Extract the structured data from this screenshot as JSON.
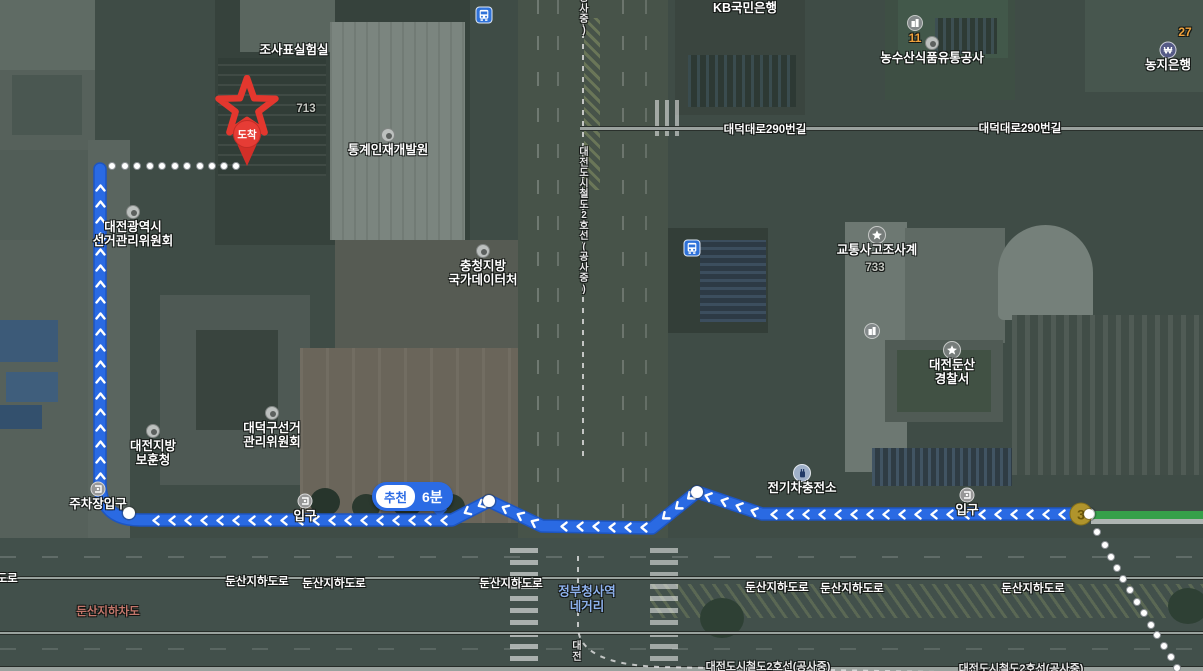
{
  "map_type": "satellite-walk-route",
  "badge": {
    "tag": "추천",
    "duration": "6분"
  },
  "destination_pin": {
    "label": "도착"
  },
  "exit_marker": {
    "number": "3"
  },
  "pois": [
    {
      "type": "label",
      "x": 294,
      "y": 44,
      "lines": [
        "조사표실험실"
      ]
    },
    {
      "type": "num_gray",
      "x": 306,
      "y": 103,
      "lines": [
        "713"
      ]
    },
    {
      "type": "dot",
      "x": 388,
      "y": 135,
      "lines": [
        "통계인재개발원"
      ]
    },
    {
      "type": "dot",
      "x": 133,
      "y": 212,
      "lines": [
        "대전광역시",
        "선거관리위원회"
      ]
    },
    {
      "type": "dot",
      "x": 483,
      "y": 251,
      "lines": [
        "충청지방",
        "국가데이터처"
      ]
    },
    {
      "type": "dot",
      "x": 272,
      "y": 413,
      "lines": [
        "대덕구선거",
        "관리위원회"
      ]
    },
    {
      "type": "dot",
      "x": 153,
      "y": 431,
      "lines": [
        "대전지방",
        "보훈청"
      ]
    },
    {
      "type": "label",
      "x": 745,
      "y": 2,
      "lines": [
        "KB국민은행"
      ]
    },
    {
      "type": "bus",
      "x": 484,
      "y": 15,
      "lines": []
    },
    {
      "type": "bus",
      "x": 692,
      "y": 248,
      "lines": []
    },
    {
      "type": "building",
      "x": 915,
      "y": 23,
      "lines": [
        "11"
      ],
      "num": "orange"
    },
    {
      "type": "dot",
      "x": 932,
      "y": 43,
      "lines": [
        "농수산식품유통공사"
      ]
    },
    {
      "type": "num_orange",
      "x": 1185,
      "y": 26,
      "lines": [
        "27"
      ]
    },
    {
      "type": "bank",
      "x": 1168,
      "y": 50,
      "lines": [
        "농지은행"
      ]
    },
    {
      "type": "police",
      "x": 877,
      "y": 235,
      "lines": [
        "교통사고조사계"
      ]
    },
    {
      "type": "num_gray",
      "x": 875,
      "y": 262,
      "lines": [
        "733"
      ]
    },
    {
      "type": "building",
      "x": 872,
      "y": 331,
      "lines": []
    },
    {
      "type": "police",
      "x": 952,
      "y": 350,
      "lines": [
        "대전둔산",
        "경찰서"
      ]
    },
    {
      "type": "ev",
      "x": 802,
      "y": 473,
      "lines": [
        "전기차충전소"
      ]
    },
    {
      "type": "entrance",
      "x": 967,
      "y": 495,
      "lines": [
        "입구"
      ]
    },
    {
      "type": "entrance",
      "x": 305,
      "y": 501,
      "lines": [
        "입구"
      ]
    },
    {
      "type": "entrance",
      "x": 98,
      "y": 489,
      "lines": [
        "주차장입구"
      ]
    }
  ],
  "road_labels": [
    {
      "text": "대덕대로290번길",
      "x": 765,
      "y": 129,
      "color": "white"
    },
    {
      "text": "대덕대로290번길",
      "x": 1020,
      "y": 128,
      "color": "white"
    },
    {
      "text": "둔산지하도로",
      "x": -14,
      "y": 578,
      "color": "white"
    },
    {
      "text": "둔산지하도로",
      "x": 257,
      "y": 581,
      "color": "white"
    },
    {
      "text": "둔산지하도로",
      "x": 334,
      "y": 583,
      "color": "white"
    },
    {
      "text": "둔산지하도로",
      "x": 511,
      "y": 583,
      "color": "white"
    },
    {
      "text": "둔산지하도로",
      "x": 777,
      "y": 587,
      "color": "white"
    },
    {
      "text": "둔산지하도로",
      "x": 852,
      "y": 588,
      "color": "white"
    },
    {
      "text": "둔산지하도로",
      "x": 1033,
      "y": 588,
      "color": "white"
    },
    {
      "text": "둔산지하차도",
      "x": 108,
      "y": 611,
      "color": "brown"
    },
    {
      "text": "정부청사역",
      "x": 587,
      "y": 590,
      "color": "blue"
    },
    {
      "text": "네거리",
      "x": 587,
      "y": 605,
      "color": "blue"
    }
  ],
  "subway_labels": [
    {
      "text": "공사중)",
      "x": 584,
      "top": -6,
      "vertical": true
    },
    {
      "text": "대전도시철도2호선(공사중)",
      "x": 584,
      "top": 148,
      "vertical": true
    },
    {
      "text": "대전",
      "x": 577,
      "top": 642,
      "vertical": true
    },
    {
      "text": "대전도시철도2호선(공사중)",
      "x": 768,
      "top": 662,
      "vertical": false
    },
    {
      "text": "대전도시철도2호선(공사중)",
      "x": 1021,
      "top": 664,
      "vertical": false
    }
  ],
  "route": {
    "color": "#2a6ae3",
    "casing": "#1d55c2",
    "d": "M1086,514 L762,514 L697,492 L652,528 L542,526 L489,501 L452,520 L140,520 Q101,520 100,484 L100,169",
    "segments": [
      [
        [
          1086,
          514
        ],
        [
          762,
          514
        ]
      ],
      [
        [
          762,
          514
        ],
        [
          697,
          492
        ]
      ],
      [
        [
          697,
          492
        ],
        [
          652,
          528
        ]
      ],
      [
        [
          652,
          528
        ],
        [
          542,
          526
        ]
      ],
      [
        [
          542,
          526
        ],
        [
          489,
          501
        ]
      ],
      [
        [
          489,
          501
        ],
        [
          452,
          520
        ]
      ],
      [
        [
          452,
          520
        ],
        [
          140,
          520
        ]
      ],
      [
        [
          100,
          484
        ],
        [
          100,
          169
        ]
      ]
    ],
    "waypoints": [
      [
        697,
        492
      ],
      [
        489,
        501
      ],
      [
        129,
        513
      ],
      [
        1089,
        514
      ]
    ],
    "dest_dots": [
      [
        112,
        166
      ],
      [
        125,
        166
      ],
      [
        137,
        166
      ],
      [
        150,
        166
      ],
      [
        162,
        166
      ],
      [
        175,
        166
      ],
      [
        187,
        166
      ],
      [
        200,
        166
      ],
      [
        212,
        166
      ],
      [
        224,
        166
      ],
      [
        236,
        166
      ]
    ],
    "start_dots": [
      [
        1097,
        532
      ],
      [
        1105,
        545
      ],
      [
        1111,
        557
      ],
      [
        1117,
        568
      ],
      [
        1123,
        579
      ],
      [
        1130,
        590
      ],
      [
        1137,
        602
      ],
      [
        1144,
        613
      ],
      [
        1151,
        625
      ],
      [
        1157,
        635
      ],
      [
        1164,
        646
      ],
      [
        1171,
        657
      ],
      [
        1177,
        668
      ]
    ],
    "subway_d": [
      "M583,0 L583,458",
      "M578,556 L578,628 Q580,664 660,667 L1160,676"
    ]
  },
  "colors": {
    "route_blue": "#2a6ae3",
    "badge_blue": "#2b6be4",
    "destination_red": "#e63c35",
    "exit_yellow": "#b0942c",
    "green_path": "#35a04a",
    "orange_number": "#f0a23c",
    "blue_road_label": "#8fb3ef",
    "brown_road_label": "#c2766b"
  }
}
